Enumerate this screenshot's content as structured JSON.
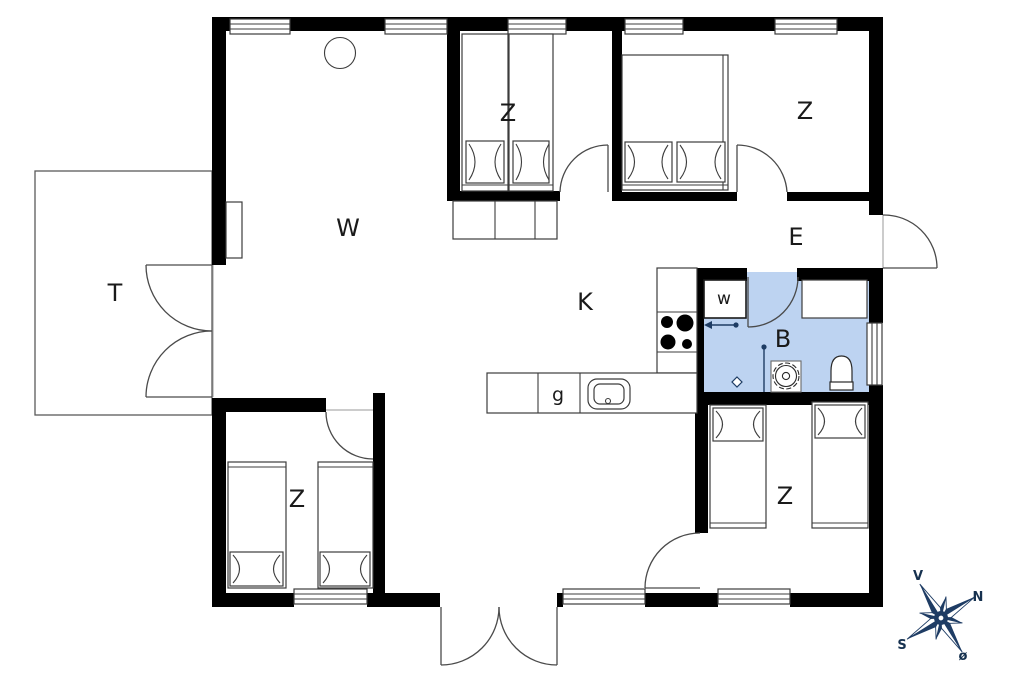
{
  "title": "Holiday house floor plan",
  "rooms": {
    "living": {
      "label": "W"
    },
    "terrace": {
      "label": "T"
    },
    "kitchen": {
      "label": "K"
    },
    "entrance": {
      "label": "E"
    },
    "bathroom": {
      "label": "B"
    },
    "utility_closet": {
      "label": "w"
    },
    "counter_cabinet": {
      "label": "g"
    },
    "bedroom_top_middle": {
      "label": "Z"
    },
    "bedroom_top_right": {
      "label": "Z"
    },
    "bedroom_bottom_right": {
      "label": "Z"
    },
    "bedroom_bottom_left": {
      "label": "Z"
    }
  },
  "compass": {
    "north": "N",
    "south": "S",
    "west": "V",
    "east": "ø"
  },
  "colors": {
    "bathroom_fill": "#bdd3f1",
    "wall": "#000000",
    "line": "#3c3c3c",
    "compass_navy": "#1e3c64"
  }
}
